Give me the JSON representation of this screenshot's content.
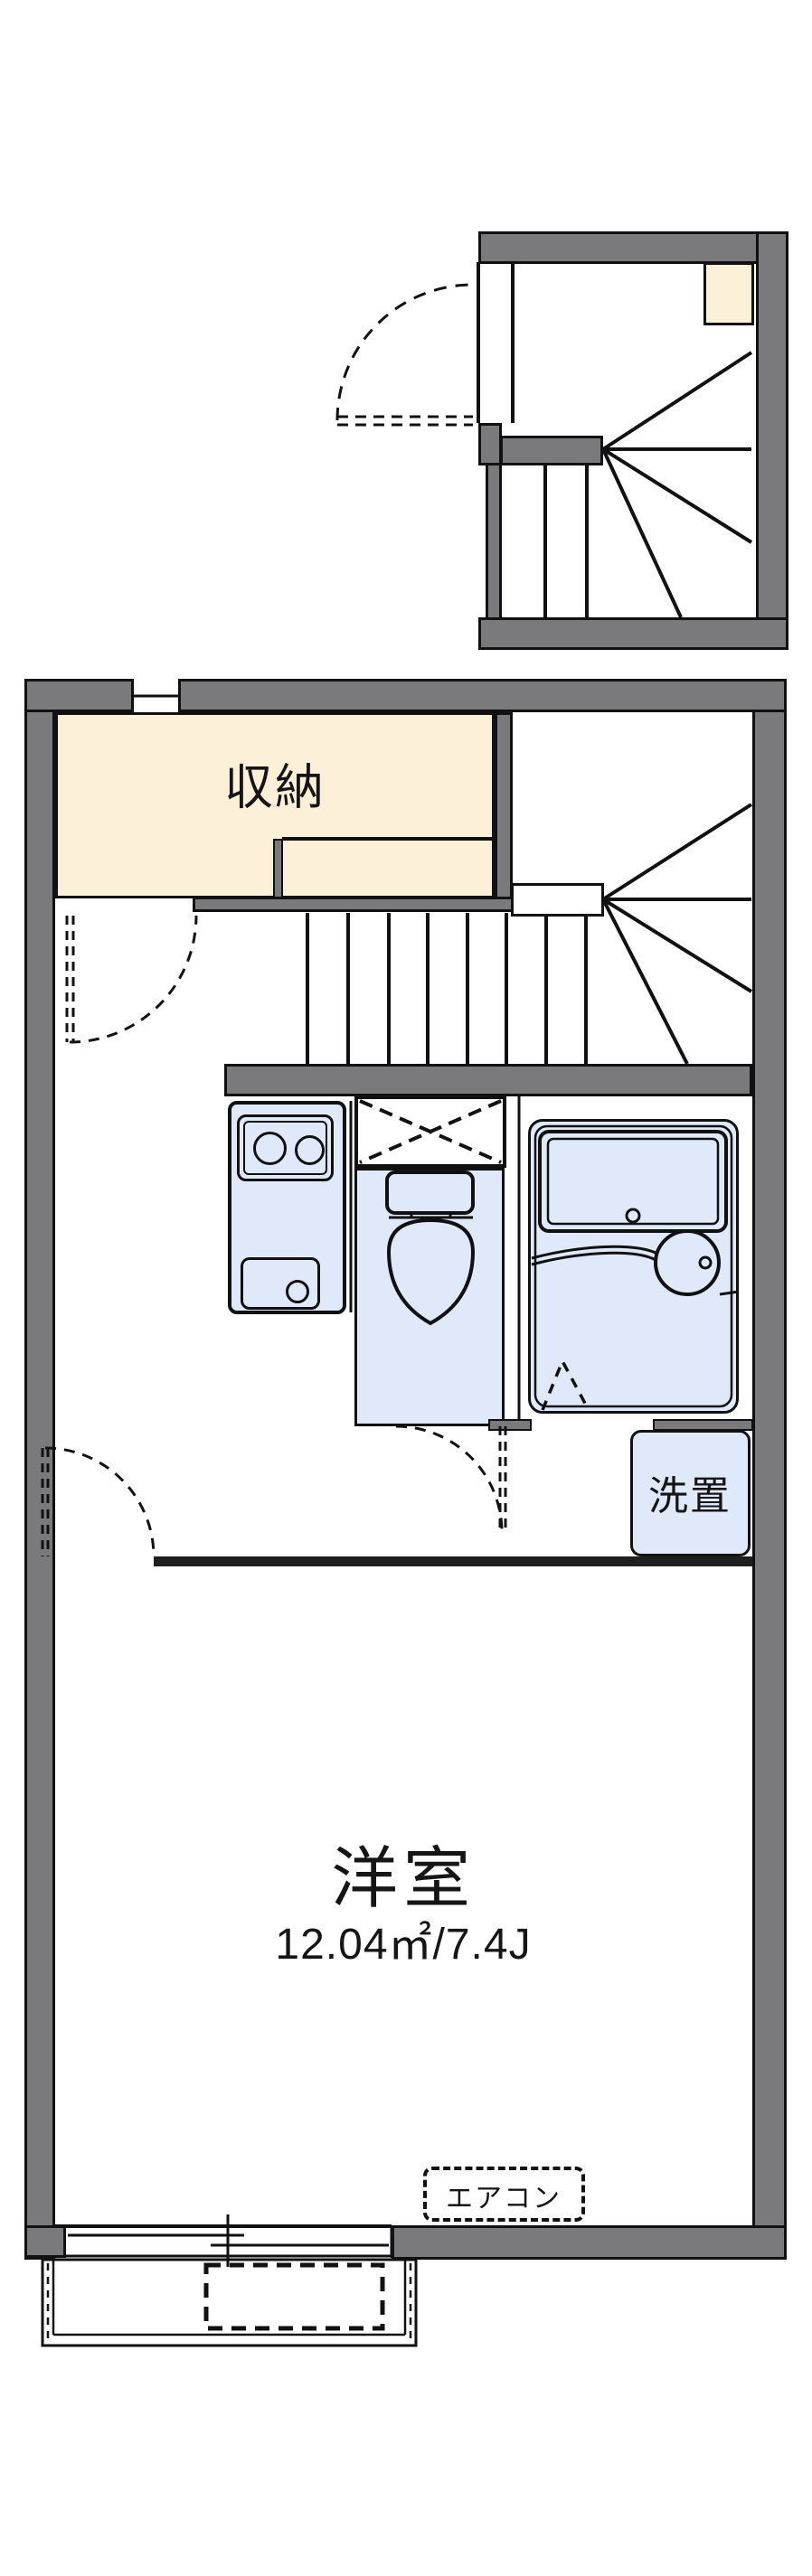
{
  "title": "apartment-floor-plan",
  "colors": {
    "wall": "#7a7a7d",
    "cream": "#fdf0d9",
    "fixture": "#dfe9fa",
    "line": "#111111",
    "wall-dark": "#1f1f1f"
  },
  "labels": {
    "closet": "収納",
    "washer": "洗置",
    "main_room": "洋室",
    "main_room_size": "12.04㎡/7.4J",
    "aircon": "エアコン"
  }
}
